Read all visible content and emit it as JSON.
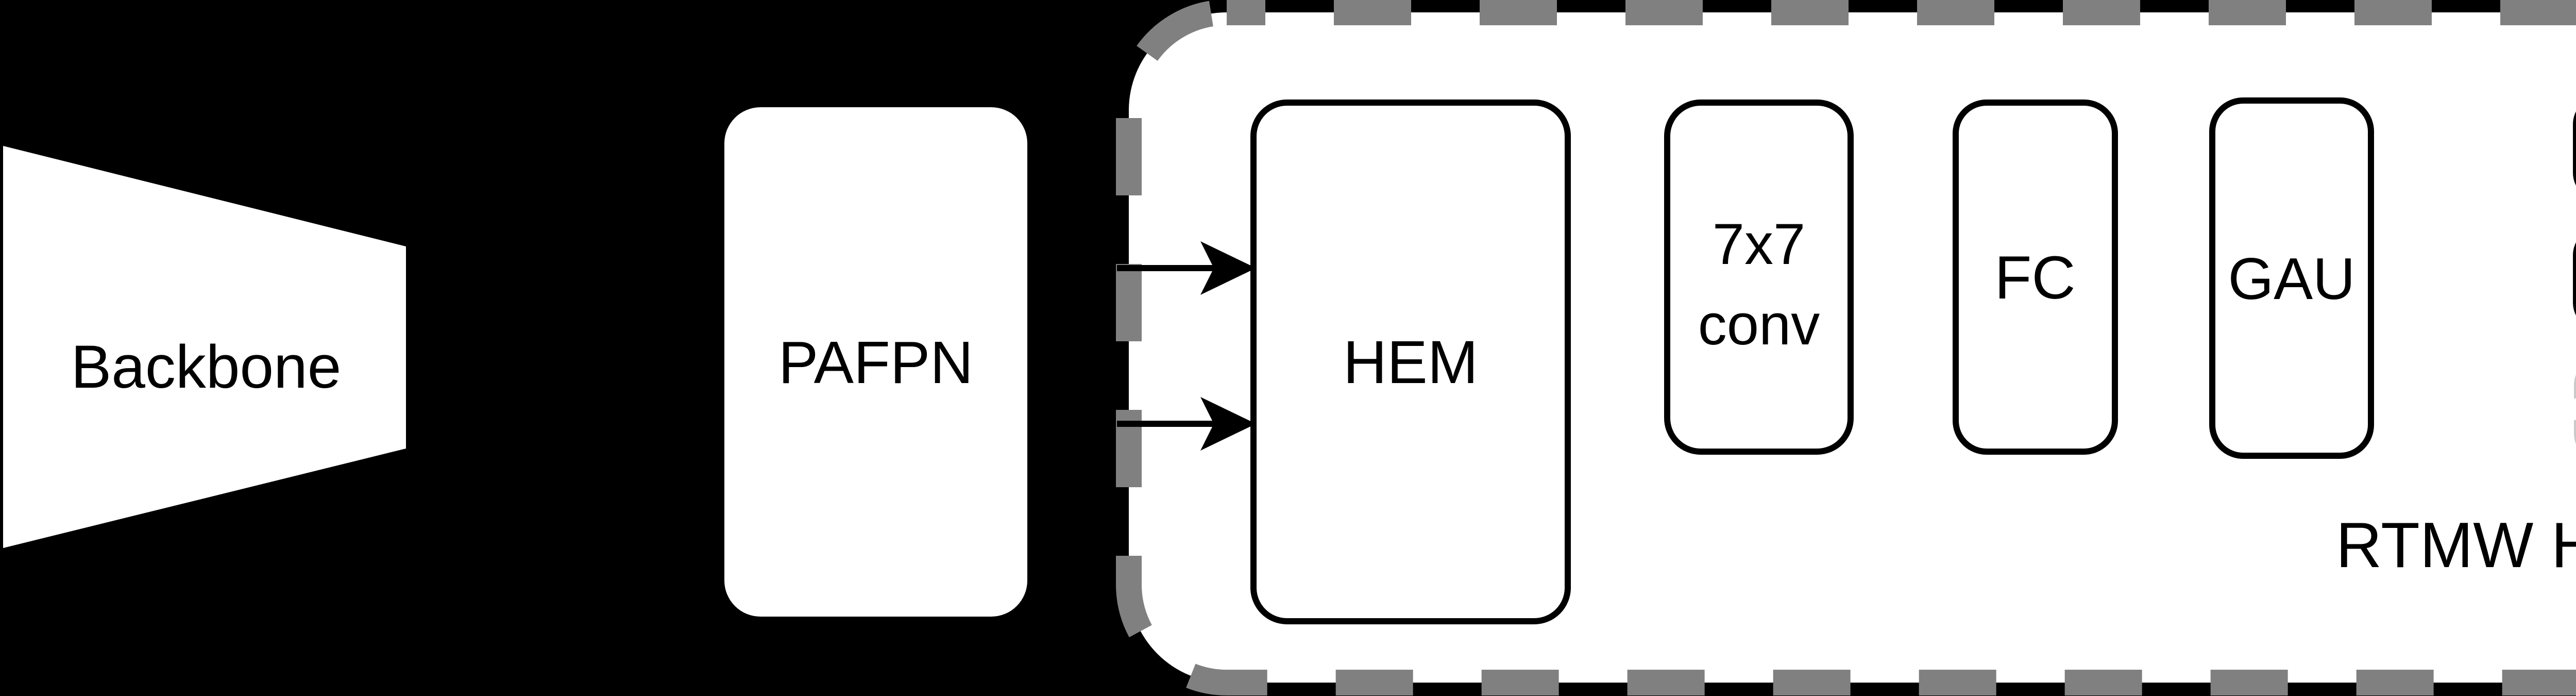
{
  "diagram": {
    "title": "RTMW model architecture",
    "colors": {
      "background": "#000000",
      "shape_fill": "#ffffff",
      "line_color": "#000000",
      "head_border_color": "#808080",
      "simcc_z_border_color": "#c9c9c9",
      "simcc_z_text_color": "#a6a6a6"
    },
    "backbone": {
      "label": "Backbone"
    },
    "pafpn": {
      "label": "PAFPN"
    },
    "rtmw_head": {
      "label": "RTMW Head",
      "hem": {
        "label": "HEM"
      },
      "conv": {
        "line1": "7x7",
        "line2": "conv"
      },
      "fc": {
        "label": "FC"
      },
      "gau": {
        "label": "GAU"
      },
      "simcc_x": {
        "label": "SimCC X"
      },
      "simcc_y": {
        "label": "SimCC Y"
      },
      "simcc_z": {
        "label": "SimCC Z"
      }
    }
  }
}
